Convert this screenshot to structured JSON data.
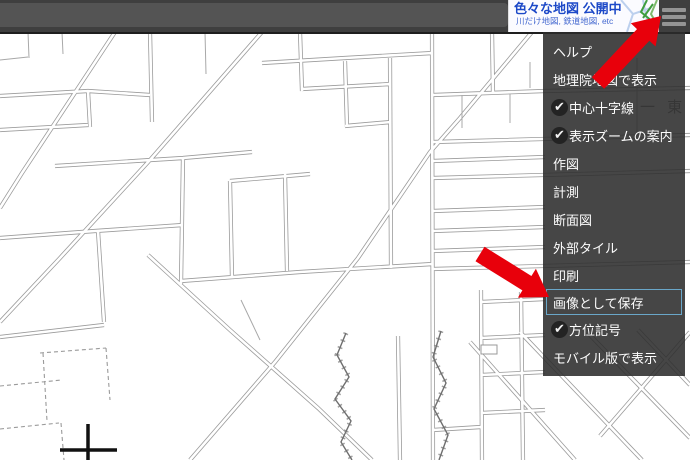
{
  "banner": {
    "title": "色々な地図 公開中",
    "subtitle": "川だけ地図, 鉄道地図, etc",
    "title_color": "#1d49c8",
    "subtitle_color": "#4468d0"
  },
  "menu": {
    "check_glyph": "✔",
    "highlight_border_color": "#6aa7c9",
    "items": [
      {
        "label": "ヘルプ",
        "checked": false,
        "highlighted": false
      },
      {
        "label": "地理院地図で表示",
        "checked": false,
        "highlighted": false
      },
      {
        "label": "中心十字線",
        "checked": true,
        "highlighted": false
      },
      {
        "label": "表示ズームの案内",
        "checked": true,
        "highlighted": false
      },
      {
        "label": "作図",
        "checked": false,
        "highlighted": false
      },
      {
        "label": "計測",
        "checked": false,
        "highlighted": false
      },
      {
        "label": "断面図",
        "checked": false,
        "highlighted": false
      },
      {
        "label": "外部タイル",
        "checked": false,
        "highlighted": false
      },
      {
        "label": "印刷",
        "checked": false,
        "highlighted": false
      },
      {
        "label": "画像として保存",
        "checked": false,
        "highlighted": true
      },
      {
        "label": "方位記号",
        "checked": true,
        "highlighted": false
      },
      {
        "label": "モバイル版で表示",
        "checked": false,
        "highlighted": false
      }
    ]
  },
  "map": {
    "label_east": "一 東"
  },
  "annotations": {
    "arrow_color": "#e8000b",
    "arrow_targets": [
      "menu-button",
      "save-as-image-item"
    ]
  }
}
